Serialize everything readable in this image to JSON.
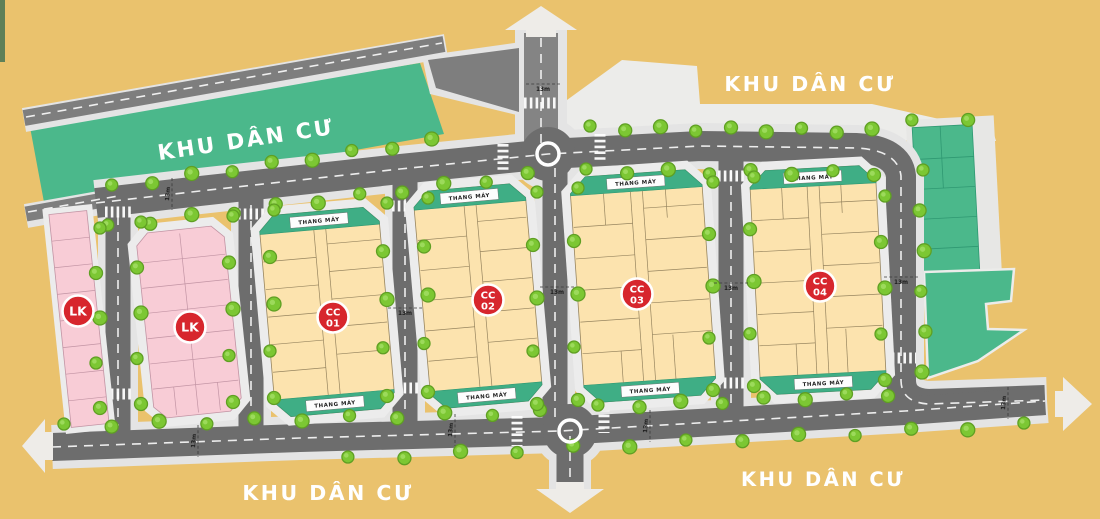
{
  "map": {
    "region_labels": {
      "residential": "KHU DÂN CƯ"
    },
    "annotations": {
      "elevator": "THANG MÁY",
      "road_width": "13m"
    },
    "blocks": {
      "lk1": {
        "label": "LK"
      },
      "lk2": {
        "label": "LK"
      },
      "cc01": {
        "code": "CC",
        "number": "01"
      },
      "cc02": {
        "code": "CC",
        "number": "02"
      },
      "cc03": {
        "code": "CC",
        "number": "03"
      },
      "cc04": {
        "code": "CC",
        "number": "04"
      }
    },
    "colors": {
      "background": "#eac26d",
      "residential_area": "#4bb88b",
      "road": "#6d6d6d",
      "sidewalk": "#e4e4e4",
      "apartment_block": "#fce3ae",
      "townhouse_block": "#f8ccd6",
      "elevator_strip": "#3fae85",
      "badge": "#d7262d",
      "tree": "#7cc733"
    }
  }
}
